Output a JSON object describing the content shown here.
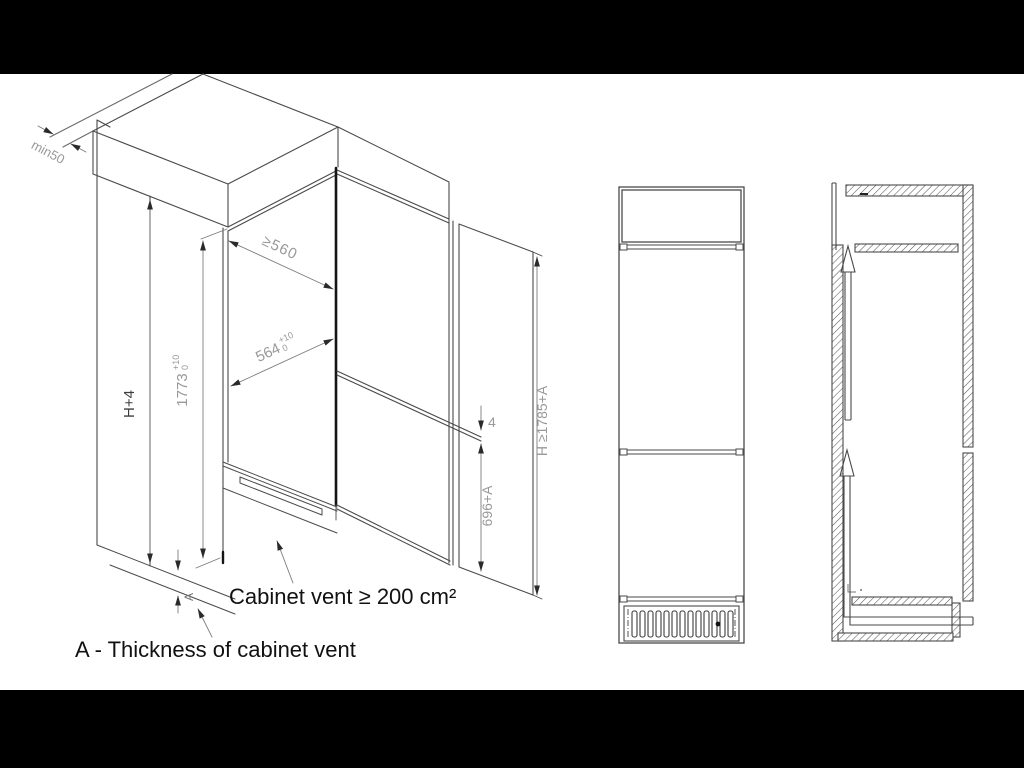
{
  "drawing": {
    "iso": {
      "min_top_clearance": "min50",
      "depth": "≥560",
      "width_main": "564",
      "width_tol_plus": "+10",
      "width_tol_zero": "0",
      "niche_height_main": "1773",
      "niche_tol_plus": "+10",
      "niche_tol_zero": "0",
      "outer_height": "H+4",
      "door_gap": "4",
      "lower_section_height": "696+A",
      "total_height": "H ≥1785+A",
      "vent_thickness_mark": "A"
    },
    "captions": {
      "cabinet_vent": "Cabinet vent ≥ 200 cm²",
      "vent_thickness": "A - Thickness of cabinet vent"
    },
    "colors": {
      "letterbox_bar": "#000000",
      "line": "#4a4a4a",
      "thick_edge": "#151515",
      "dimension_text": "#999999",
      "outer_height_text": "#3d3d3d",
      "caption_text": "#111111",
      "background": "#ffffff"
    }
  }
}
